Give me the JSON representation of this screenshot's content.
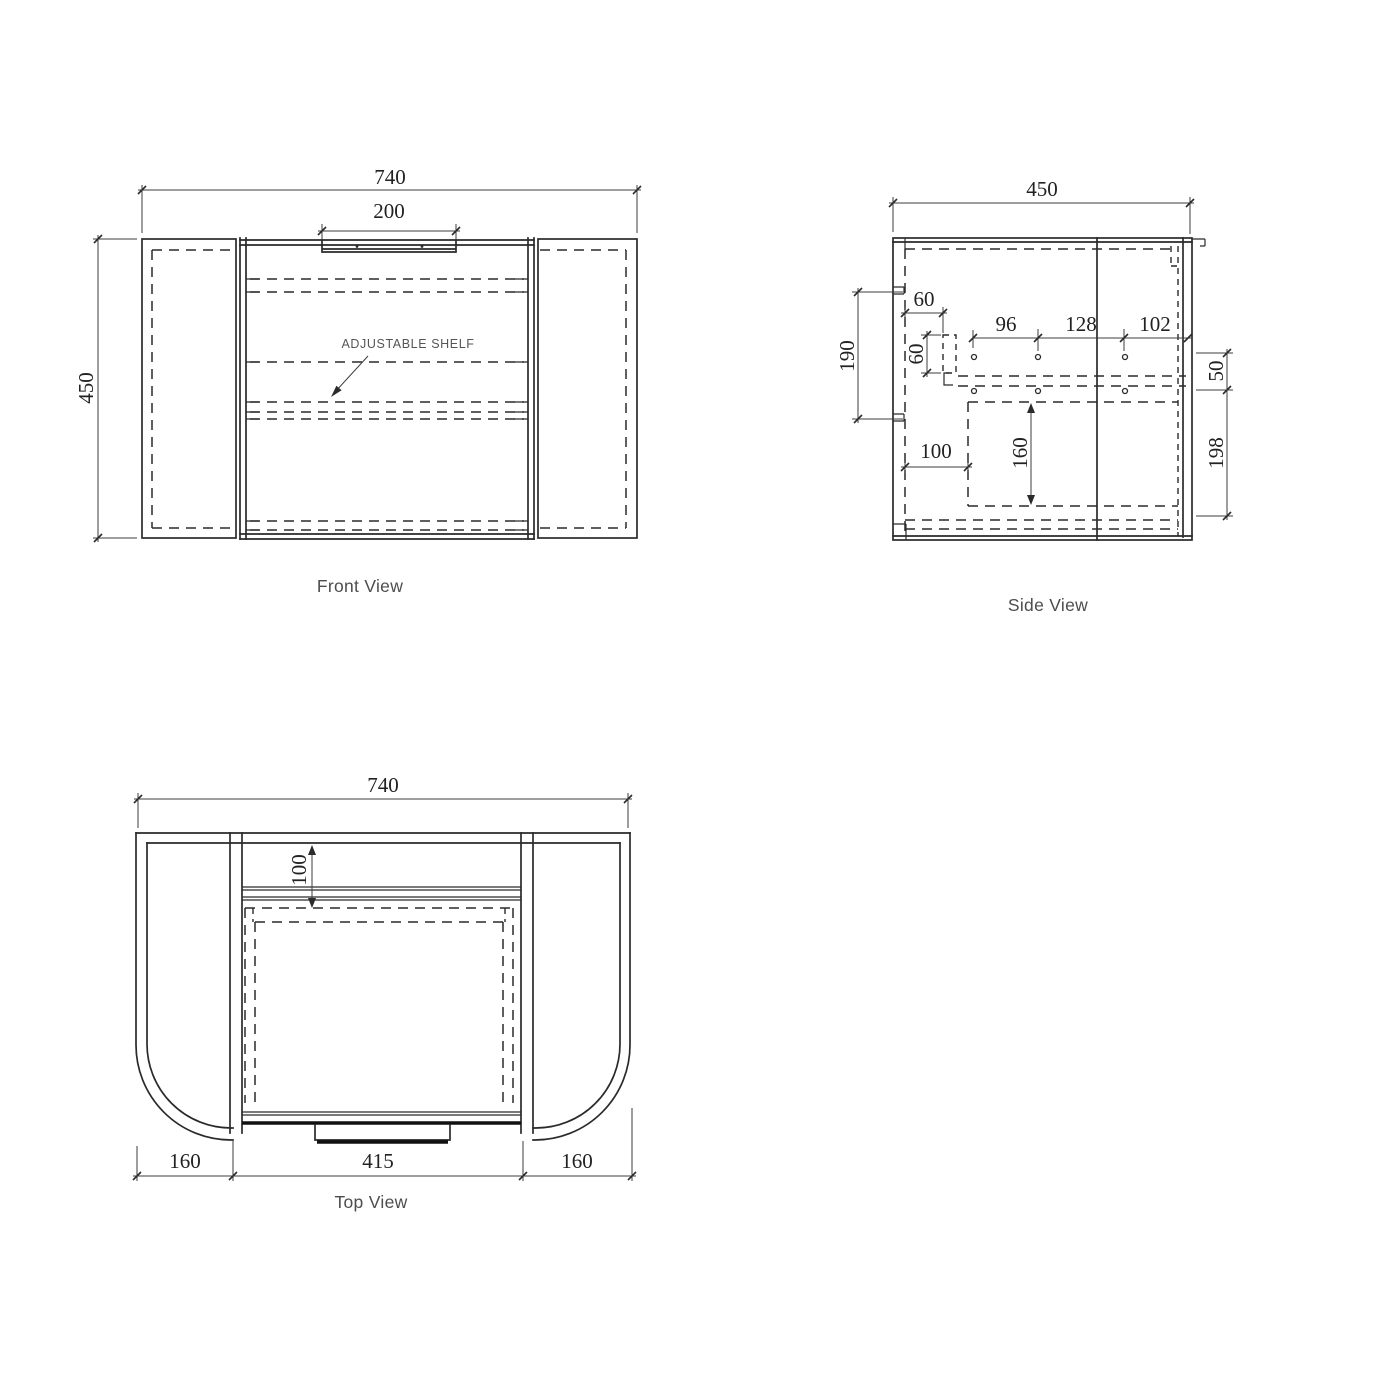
{
  "page": {
    "background": "#ffffff",
    "line_color": "#2a2a2a",
    "dim_text_color": "#222222"
  },
  "front_view": {
    "label": "Front View",
    "shelf_annotation": "ADJUSTABLE SHELF",
    "dim_overall_width": "740",
    "dim_handle_width": "200",
    "dim_overall_height": "450"
  },
  "side_view": {
    "label": "Side View",
    "dim_overall_depth": "450",
    "dim_rail_drop": "190",
    "dim_rail_inset": "60",
    "dim_rail_size": "60",
    "dim_hole_pitch_a": "96",
    "dim_hole_pitch_b": "128",
    "dim_hole_front_offset": "102",
    "dim_hole_row_gap": "50",
    "dim_recess_offset": "100",
    "dim_recess_depth": "160",
    "dim_bottom_zone": "198"
  },
  "top_view": {
    "label": "Top View",
    "dim_overall_width": "740",
    "dim_back_inset": "100",
    "dim_wing_left": "160",
    "dim_door_width": "415",
    "dim_wing_right": "160"
  }
}
